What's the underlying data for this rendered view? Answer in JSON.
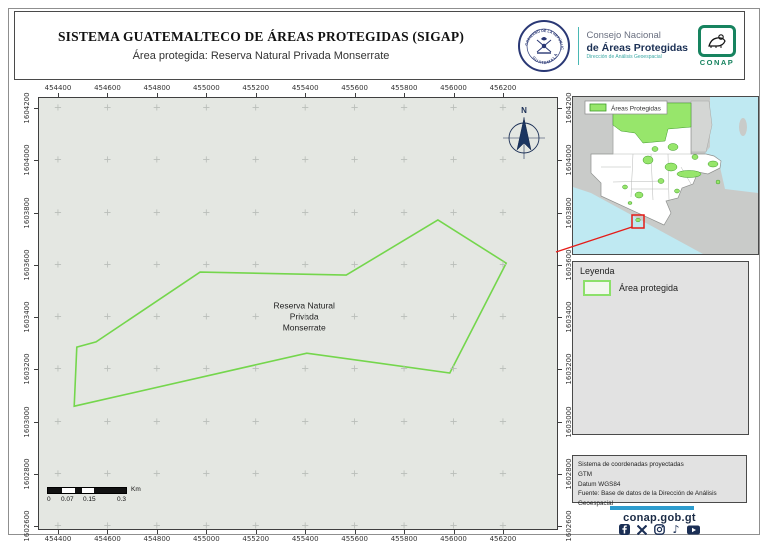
{
  "header": {
    "title": "SISTEMA GUATEMALTECO DE ÁREAS PROTEGIDAS  (SIGAP)",
    "subtitle": "Área protegida: Reserva Natural Privada Monserrate",
    "seal_text_top": "GOBIERNO DE LA REPÚBLICA",
    "seal_text_bottom": "GUATEMALA",
    "org_line1": "Consejo Nacional",
    "org_line2": "de Áreas Protegidas",
    "org_line3": "Dirección de Análisis Geoespacial",
    "conap_label": "CONAP"
  },
  "map": {
    "x_ticks": [
      "454400",
      "454600",
      "454800",
      "455000",
      "455200",
      "455400",
      "455600",
      "455800",
      "456000",
      "456200"
    ],
    "y_ticks": [
      "1604200",
      "1604000",
      "1603800",
      "1603600",
      "1603400",
      "1603200",
      "1603000",
      "1602800",
      "1602600"
    ],
    "north_label": "N",
    "area_label": [
      "Reserva Natural",
      "Privada",
      "Monserrate"
    ],
    "polygon_stroke": "#74d64c",
    "polygon_points": [
      [
        0.311,
        0.404
      ],
      [
        0.593,
        0.411
      ],
      [
        0.77,
        0.283
      ],
      [
        0.902,
        0.383
      ],
      [
        0.793,
        0.638
      ],
      [
        0.517,
        0.592
      ],
      [
        0.068,
        0.715
      ],
      [
        0.073,
        0.578
      ],
      [
        0.11,
        0.566
      ]
    ],
    "scalebar": {
      "labels": [
        "0",
        "0.07",
        "0.15",
        "0.3"
      ],
      "label_lefts": [
        0,
        14,
        36,
        70
      ],
      "unit": "Km",
      "segments": [
        {
          "w": 18,
          "c": "#111111"
        },
        {
          "w": 16,
          "c": "#ffffff"
        },
        {
          "w": 9,
          "c": "#111111"
        },
        {
          "w": 16,
          "c": "#ffffff"
        },
        {
          "w": 41,
          "c": "#111111"
        }
      ]
    }
  },
  "inset": {
    "legend_label": "Áreas Protegidas"
  },
  "legend_panel": {
    "title": "Leyenda",
    "item": "Área protegida"
  },
  "info_panel": {
    "lines": [
      "Sistema de coordenadas proyectadas",
      "GTM",
      "Datum WGS84",
      "Fuente: Base de datos de la Dirección de Análisis Geoespacial"
    ]
  },
  "footer": {
    "website": "conap.gob.gt"
  },
  "colors": {
    "accent_blue": "#2d9cce",
    "navy": "#1b2f55",
    "conap_green": "#17835f",
    "red": "#e51c18",
    "protected_green": "#97e66b",
    "map_bg": "#e4e7e2"
  }
}
